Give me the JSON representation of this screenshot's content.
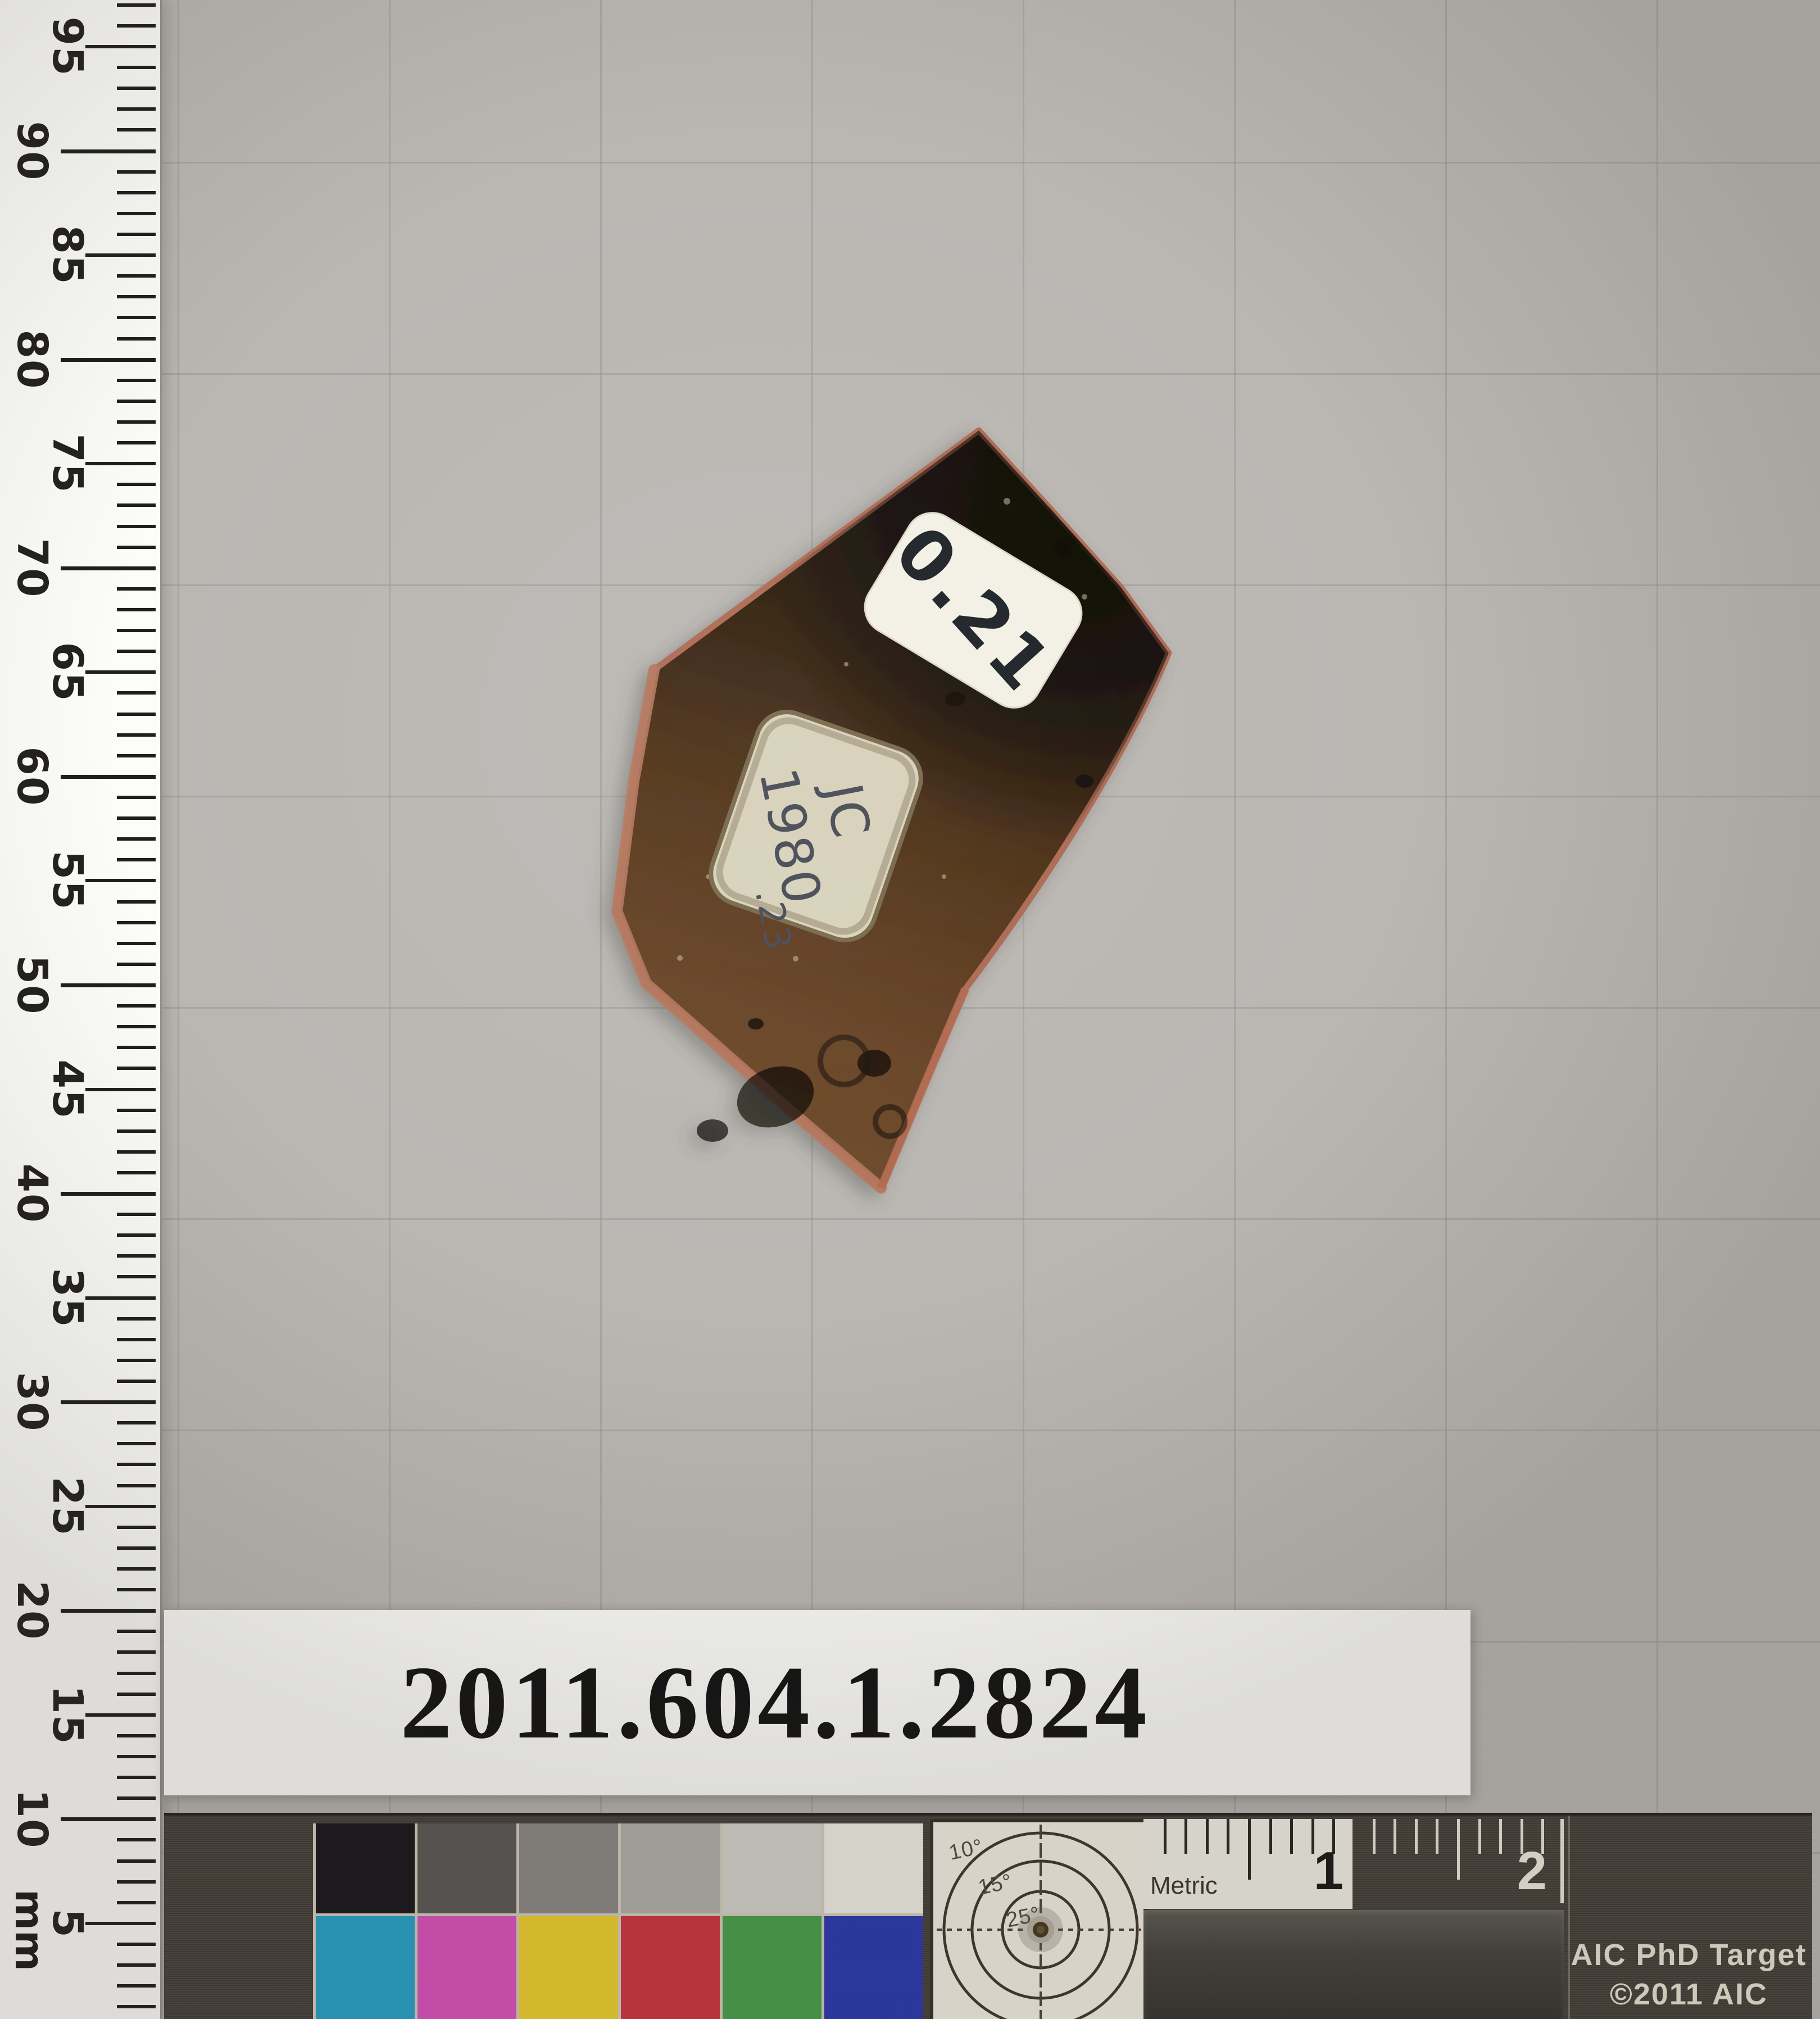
{
  "photo": {
    "background_color": "#bab7b3",
    "grid_color": "#8f938a",
    "grid_spacing_px": 376
  },
  "ruler": {
    "unit": "mm",
    "labels": [
      95,
      90,
      85,
      80,
      75,
      70,
      65,
      60,
      55,
      50,
      45,
      40,
      35,
      30,
      25,
      20,
      15,
      10,
      5
    ],
    "tick_color": "#201e1c"
  },
  "artifact": {
    "tag_number": "0.21",
    "old_label": {
      "line1": "JC",
      "line2": "1980",
      "line3": ".23"
    },
    "glaze_dark_color": "#1c130c",
    "body_brown_color": "#5a3b20",
    "edge_clay_color": "#b06e54"
  },
  "accession": {
    "number": "2011.604.1.2824"
  },
  "color_target": {
    "title_line1": "AIC PhD Target",
    "title_line2": "©2011 AIC",
    "metric_label": "Metric",
    "cm_labels": [
      "1",
      "2"
    ],
    "angle_labels": [
      "10°",
      "15°",
      "25°"
    ],
    "gray_patches": [
      "#17151a",
      "#5b5855",
      "#8b8885",
      "#b4b1ad",
      "#d7d4ce",
      "#f3f0e7"
    ],
    "color_patches": [
      "#25a2ca",
      "#dc50bd",
      "#f0d02c",
      "#cf3340",
      "#47a04c",
      "#2837ae"
    ]
  }
}
